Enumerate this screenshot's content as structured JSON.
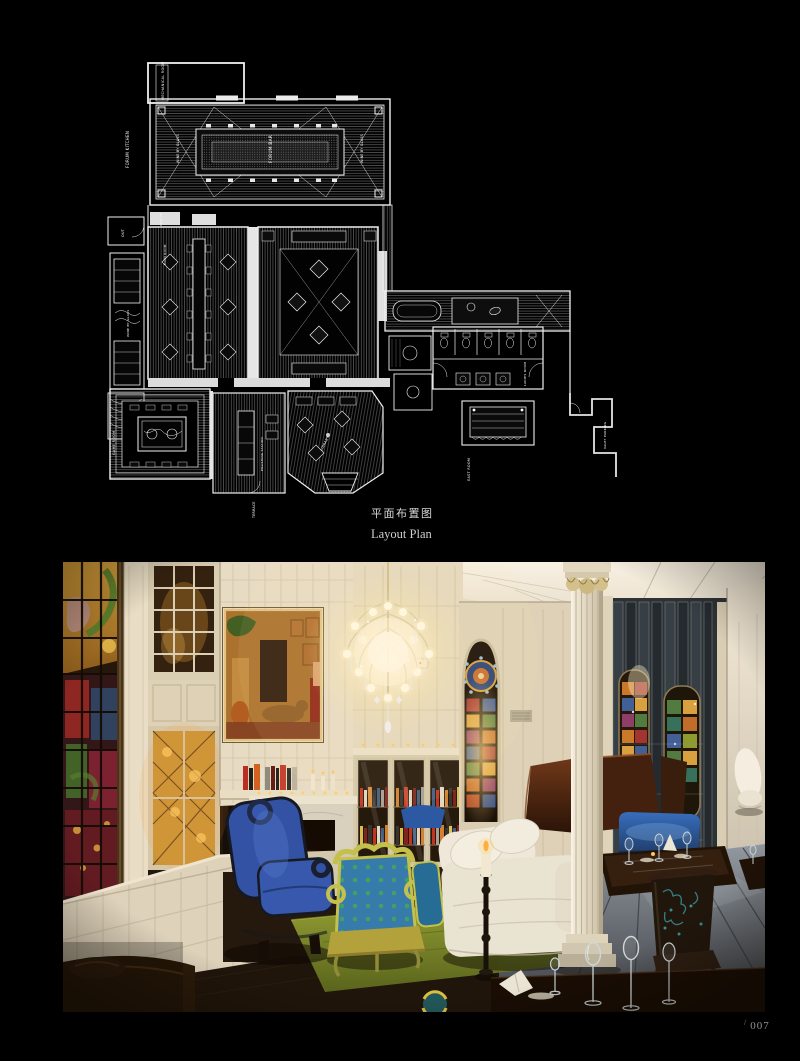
{
  "page": {
    "background": "#000000",
    "folio": {
      "prefix": "/",
      "number": "007"
    }
  },
  "plan": {
    "caption_zh": "平面布置图",
    "caption_en": "Layout Plan",
    "line_color": "#f0f0f0",
    "labels": {
      "mechanical_room": "MECHANICAL ROOM",
      "forum_kitchen": "FORUM KITCHEN",
      "forum_bar": "FORUM BAR",
      "wine_by_glass_left": "WINE BY GLASS",
      "wine_by_glass_right": "WINE BY GLASS",
      "wine_storage": "WINE BY GLASS",
      "out": "OUT",
      "main_room": "MAIN ROOM",
      "pick_up": "PICK UP",
      "ladies_room": "LADIES ROOM",
      "east_room": "EAST ROOM",
      "valet_parking": "VALET PARKING",
      "game_room": "GAME ROOM",
      "polishing_station": "POLISHING STATION",
      "terrace": "TERRACE",
      "library": "LIBRARY"
    }
  },
  "photo": {
    "colors": {
      "chandelier_glow": "#fff3d6",
      "wall_cream": "#e6ddc8",
      "blue_chair": "#2a4faa",
      "polka_upholstery": "#2e7ab0",
      "frame_yellow": "#c2c24e",
      "rug_green": "#7a8a28",
      "booth_brown": "#3a1c10",
      "banquette_blue": "#1d4f9e",
      "floor_grey": "#4a525e",
      "stained_glass_amber": "#d89a3a"
    }
  }
}
